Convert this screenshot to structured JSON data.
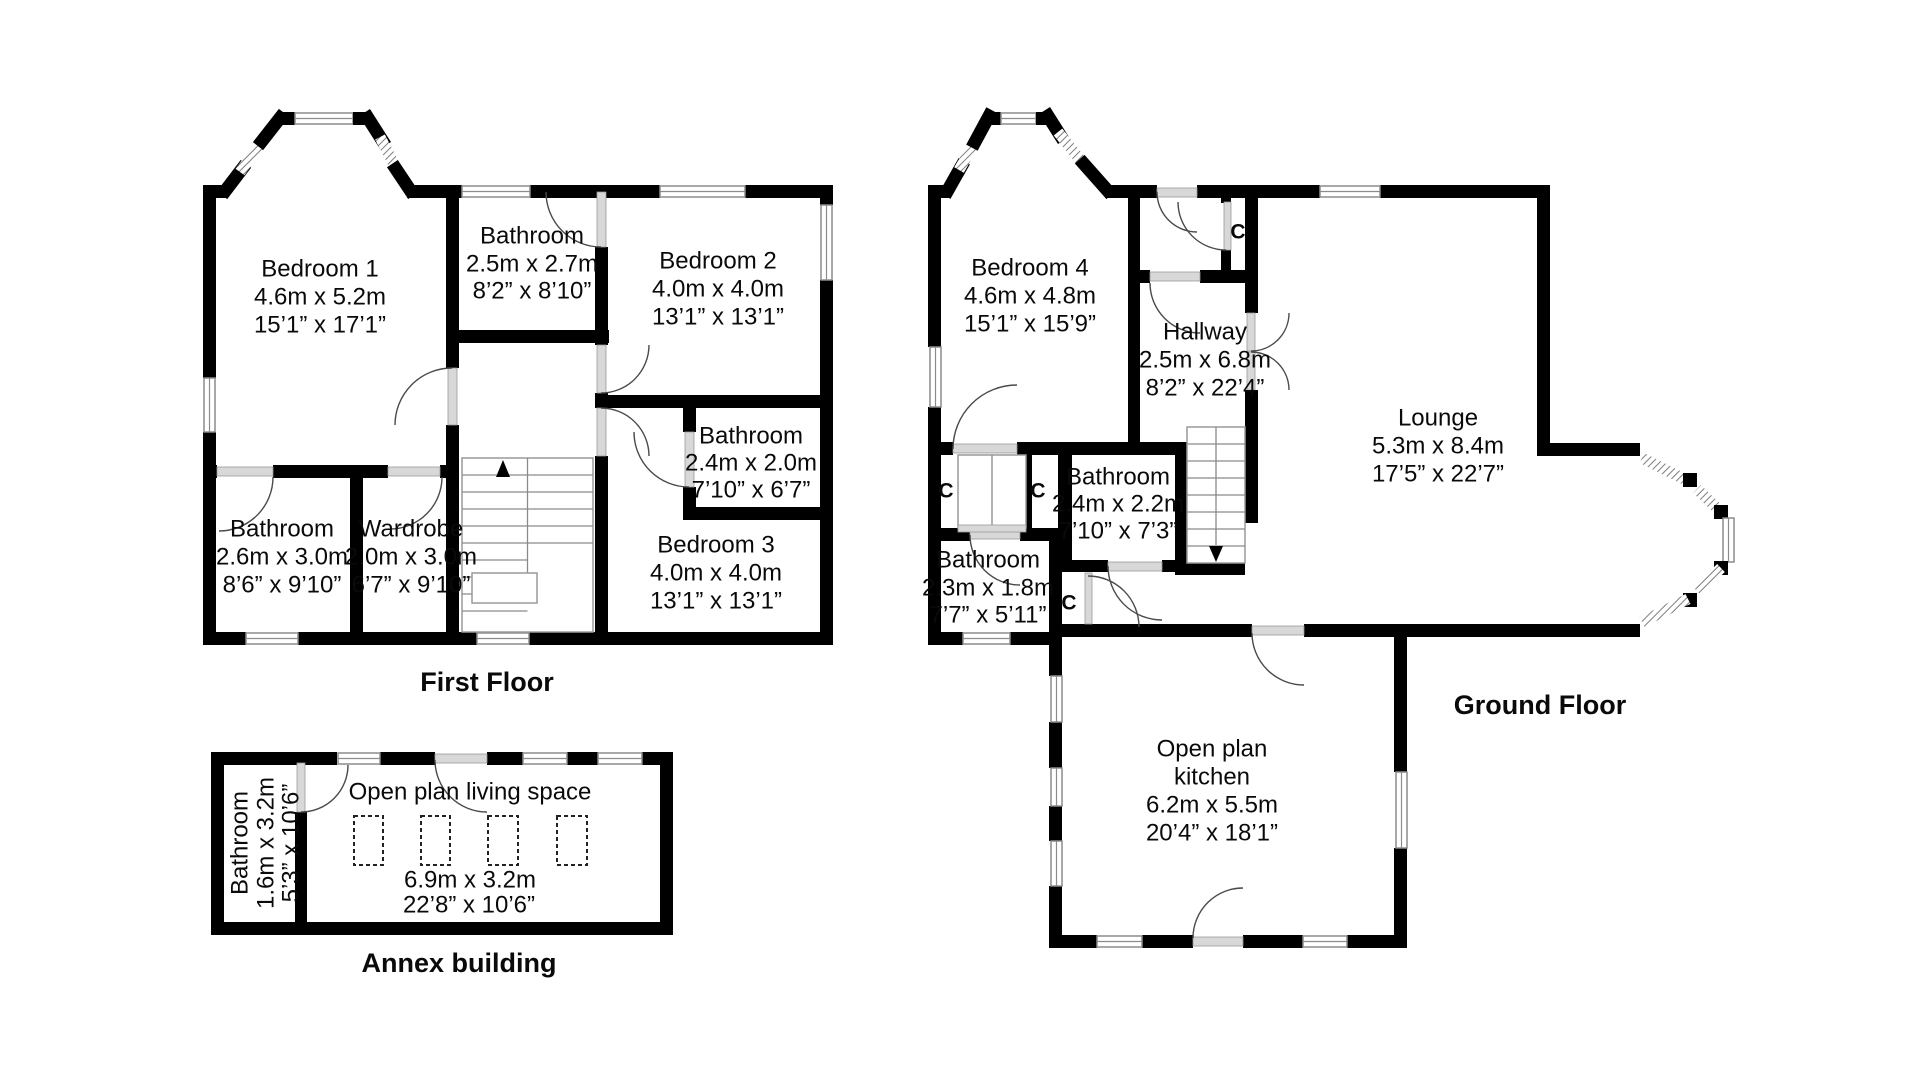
{
  "page": {
    "background": "#ffffff",
    "wall_color": "#000000"
  },
  "first_floor": {
    "title": "First Floor",
    "bedroom1": {
      "name": "Bedroom 1",
      "metric": "4.6m x 5.2m",
      "imperial": "15’1” x 17’1”"
    },
    "bathroom_top": {
      "name": "Bathroom",
      "metric": "2.5m x 2.7m",
      "imperial": "8’2” x 8’10”"
    },
    "bedroom2": {
      "name": "Bedroom 2",
      "metric": "4.0m x 4.0m",
      "imperial": "13’1” x 13’1”"
    },
    "bathroom_middle": {
      "name": "Bathroom",
      "metric": "2.4m x 2.0m",
      "imperial": "7’10” x 6’7”"
    },
    "bedroom3": {
      "name": "Bedroom 3",
      "metric": "4.0m x 4.0m",
      "imperial": "13’1” x 13’1”"
    },
    "bathroom_left": {
      "name": "Bathroom",
      "metric": "2.6m x 3.0m",
      "imperial": "8’6” x 9’10”"
    },
    "wardrobe": {
      "name": "Wardrobe",
      "metric": "2.0m x 3.0m",
      "imperial": "6’7” x 9’10”"
    }
  },
  "ground_floor": {
    "title": "Ground Floor",
    "bedroom4": {
      "name": "Bedroom 4",
      "metric": "4.6m x 4.8m",
      "imperial": "15’1” x 15’9”"
    },
    "hallway": {
      "name": "Hallway",
      "metric": "2.5m x 6.8m",
      "imperial": "8’2” x 22’4”"
    },
    "lounge": {
      "name": "Lounge",
      "metric": "5.3m x 8.4m",
      "imperial": "17’5” x 22’7”"
    },
    "bathroom_middle": {
      "name": "Bathroom",
      "metric": "2.4m x 2.2m",
      "imperial": "7’10” x 7’3”"
    },
    "bathroom_left": {
      "name": "Bathroom",
      "metric": "2.3m x 1.8m",
      "imperial": "7’7” x 5’11”"
    },
    "kitchen": {
      "name_line1": "Open plan",
      "name_line2": "kitchen",
      "metric": "6.2m x 5.5m",
      "imperial": "20’4” x 18’1”"
    },
    "closet_label": "C"
  },
  "annex": {
    "title": "Annex building",
    "living_space": {
      "name": "Open plan living space",
      "metric": "6.9m x 3.2m",
      "imperial": "22’8” x 10’6”"
    },
    "bathroom": {
      "name": "Bathroom",
      "metric": "1.6m x 3.2m",
      "imperial": "5’3” x 10’6”"
    }
  }
}
